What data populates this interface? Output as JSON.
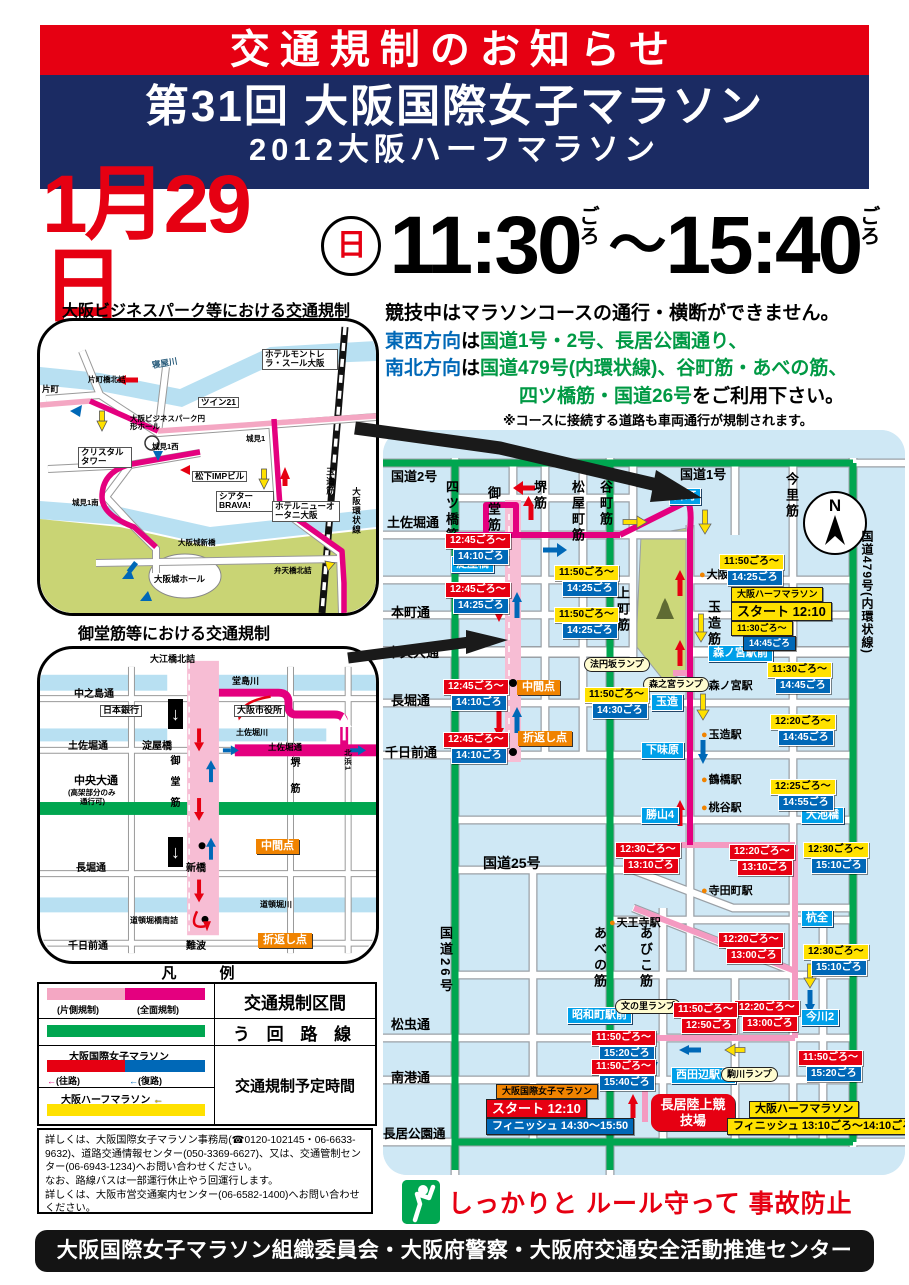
{
  "header": {
    "notice": "交通規制のお知らせ",
    "event_title": "第31回 大阪国際女子マラソン",
    "event_subtitle": "2012大阪ハーフマラソン"
  },
  "schedule": {
    "date": "1月29日",
    "circle_day": "日",
    "time_start": "11:30",
    "time_end": "15:40",
    "approx1": "ごろ",
    "approx2": "ごろ",
    "tilde": "〜"
  },
  "notice_text": {
    "line1": "競技中はマラソンコースの通行・横断ができません。",
    "line2_blue": "東西方向",
    "line2_mid": "は",
    "line2_green": "国道1号・2号、長居公園通り、",
    "line3_blue": "南北方向",
    "line3_mid": "は",
    "line3_green": "国道479号(内環状線)、谷町筋・あべの筋、",
    "line4_green": "四ツ橋筋・国道26号",
    "line4_end": "をご利用下さい。",
    "note": "※コースに接続する道路も車両通行が規制されます。"
  },
  "map1": {
    "title": "大阪ビジネスパーク等における交通規制",
    "labels": [
      "片町",
      "片町橋北詰",
      "寝屋川",
      "ホテルモントレ ラ・スール大阪",
      "ツイン21",
      "大阪ビジネスパーク円形ホール",
      "クリスタルタワー",
      "城見1西",
      "松下IMPビル",
      "城見1南",
      "城見1",
      "シアターBRAVA!",
      "ホテルニューオータニ大阪",
      "大阪城新橋",
      "弁天橋北詰",
      "大阪城ホール",
      "玉造筋",
      "大阪環状線"
    ]
  },
  "map2": {
    "title": "御堂筋等における交通規制",
    "labels": [
      "大江橋北詰",
      "堂島川",
      "中之島通",
      "日本銀行",
      "大阪市役所",
      "土佐堀川",
      "土佐堀通",
      "淀屋橋",
      "土佐堀通",
      "北浜1",
      "堺筋",
      "中央大通",
      "(高架部分のみ",
      "通行可)",
      "御堂筋",
      "中間点",
      "新橋",
      "長堀通",
      "道頓堀川",
      "道頓堀橋南詰",
      "折返し点",
      "千日前通",
      "難波"
    ]
  },
  "icons": {
    "one_way_down": "↓",
    "arrow_left": "←"
  },
  "legend": {
    "title": "凡　例",
    "half_closed": "(片側規制)",
    "full_closed": "(全面規制)",
    "zone": "交通規制区間",
    "detour": "う 回 路 線",
    "women": "大阪国際女子マラソン",
    "outbound": "(往路)",
    "inbound": "(復路)",
    "half": "大阪ハーフマラソン",
    "time": "交通規制予定時間"
  },
  "contact": {
    "lines": [
      "詳しくは、大阪国際女子マラソン事務局(☎0120-102145・06-6633-9632)、道路交通情報センター(050-3369-6627)、又は、交通管制センター(06-6943-1234)へお問い合わせください。",
      "なお、路線バスは一部運行休止やう回運行します。",
      "詳しくは、大阪市営交通案内センター(06-6582-1400)へお問い合わせください。"
    ]
  },
  "main_map": {
    "compass": "N",
    "roads_h": [
      "国道2号",
      "土佐堀通",
      "本町通",
      "中央大通",
      "長堀通",
      "千日前通",
      "国道25号",
      "松虫通",
      "南港通",
      "長居公園通",
      "国道1号"
    ],
    "roads_v": [
      "四ツ橋筋",
      "御堂筋",
      "堺筋",
      "松屋町筋",
      "谷町筋",
      "上町筋",
      "玉造筋",
      "今里筋",
      "国道479号(内環状線)",
      "国道26号",
      "あべの筋",
      "あびこ筋"
    ],
    "stations": [
      "大阪城公園駅",
      "森ノ宮駅",
      "玉造駅",
      "鶴橋駅",
      "桃谷駅",
      "寺田町駅",
      "天王寺駅"
    ],
    "junctions": [
      "淀屋橋",
      "片町",
      "森ノ宮駅前",
      "玉造",
      "下味原",
      "勝山4",
      "大池橋",
      "杭全",
      "今川2",
      "昭和町駅前",
      "西田辺駅前"
    ],
    "ramps": [
      "法円坂ランプ",
      "森之宮ランプ",
      "文の里ランプ",
      "駒川ランプ"
    ],
    "points": [
      "中間点",
      "折返し点"
    ],
    "badges": [
      {
        "s": "12:45ごろ〜",
        "e": "14:10ごろ",
        "sc": "#e60012",
        "ec": "#0068b7"
      },
      {
        "s": "12:45ごろ〜",
        "e": "14:25ごろ",
        "sc": "#e60012",
        "ec": "#0068b7"
      },
      {
        "s": "11:50ごろ〜",
        "e": "14:25ごろ",
        "sc": "#ffe100",
        "ec": "#0068b7"
      },
      {
        "s": "11:50ごろ〜",
        "e": "14:25ごろ",
        "sc": "#ffe100",
        "ec": "#0068b7"
      },
      {
        "s": "11:50ごろ〜",
        "e": "14:25ごろ",
        "sc": "#ffe100",
        "ec": "#0068b7"
      },
      {
        "s": "11:50ごろ〜",
        "e": "14:30ごろ",
        "sc": "#ffe100",
        "ec": "#0068b7"
      },
      {
        "s": "12:45ごろ〜",
        "e": "14:10ごろ",
        "sc": "#e60012",
        "ec": "#0068b7"
      },
      {
        "s": "12:45ごろ〜",
        "e": "14:10ごろ",
        "sc": "#e60012",
        "ec": "#0068b7"
      },
      {
        "s": "11:30ごろ〜",
        "e": "14:45ごろ",
        "sc": "#ffe100",
        "ec": "#0068b7"
      },
      {
        "s": "12:20ごろ〜",
        "e": "14:45ごろ",
        "sc": "#ffe100",
        "ec": "#0068b7"
      },
      {
        "s": "12:25ごろ〜",
        "e": "14:55ごろ",
        "sc": "#ffe100",
        "ec": "#0068b7"
      },
      {
        "s": "12:30ごろ〜",
        "e": "13:10ごろ",
        "sc": "#e60012",
        "ec": "#e60012"
      },
      {
        "s": "12:20ごろ〜",
        "e": "13:10ごろ",
        "sc": "#e60012",
        "ec": "#e60012"
      },
      {
        "s": "12:30ごろ〜",
        "e": "15:10ごろ",
        "sc": "#ffe100",
        "ec": "#0068b7"
      },
      {
        "s": "12:20ごろ〜",
        "e": "13:00ごろ",
        "sc": "#e60012",
        "ec": "#e60012"
      },
      {
        "s": "12:30ごろ〜",
        "e": "15:10ごろ",
        "sc": "#ffe100",
        "ec": "#0068b7"
      },
      {
        "s": "11:50ごろ〜",
        "e": "15:20ごろ",
        "sc": "#e60012",
        "ec": "#0068b7"
      },
      {
        "s": "12:20ごろ〜",
        "e": "13:00ごろ",
        "sc": "#e60012",
        "ec": "#e60012"
      },
      {
        "s": "11:50ごろ〜",
        "e": "12:50ごろ",
        "sc": "#e60012",
        "ec": "#e60012"
      },
      {
        "s": "11:50ごろ〜",
        "e": "15:20ごろ",
        "sc": "#e60012",
        "ec": "#0068b7"
      },
      {
        "s": "11:50ごろ〜",
        "e": "15:40ごろ",
        "sc": "#e60012",
        "ec": "#0068b7"
      }
    ],
    "start_half": [
      "大阪ハーフマラソン",
      "スタート 12:10",
      "11:30ごろ〜",
      "14:45ごろ"
    ],
    "start_women": [
      "大阪国際女子マラソン",
      "スタート 12:10",
      "フィニッシュ 14:30〜15:50"
    ],
    "finish_half": [
      "大阪ハーフマラソン",
      "フィニッシュ 13:10ごろ〜14:10ごろ"
    ],
    "stadium": "長居陸上競技場"
  },
  "slogan": {
    "text": "しっかりと ルール守って 事故防止"
  },
  "footer": {
    "text": "大阪国際女子マラソン組織委員会・大阪府警察・大阪府交通安全活動推進センター"
  },
  "colors": {
    "course_full": "#e4007f",
    "course_half": "#f49ac1",
    "detour": "#00a650",
    "accent_red": "#e60012",
    "accent_blue": "#0068b7",
    "accent_yellow": "#ffe100",
    "map_bg": "#cfe8f5"
  }
}
